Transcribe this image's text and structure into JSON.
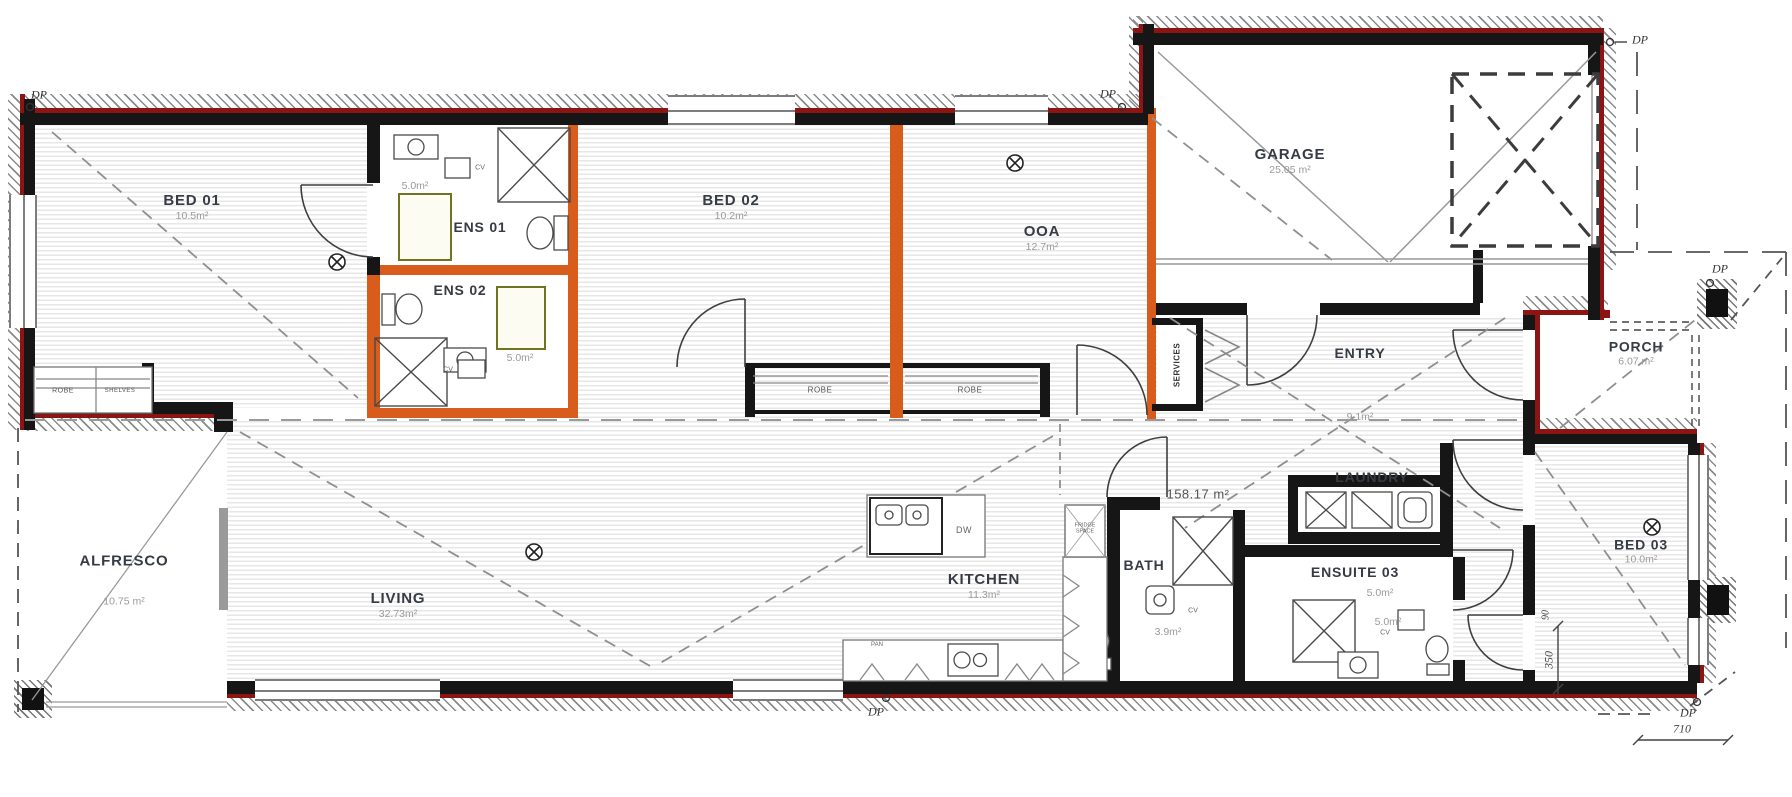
{
  "colors": {
    "wall_black": "#161616",
    "exterior_red": "#8c1412",
    "feature_orange": "#d85c1c",
    "hatch_gray": "#8a8a8a",
    "floor_stripe": "#e7e7e7",
    "mat_olive": "#6f7421"
  },
  "rooms": {
    "bed01": {
      "name": "BED 01",
      "area": "10.5m²"
    },
    "ens01": {
      "name": "ENS 01",
      "area": "5.0m²"
    },
    "ens02": {
      "name": "ENS 02",
      "area": "5.0m²"
    },
    "bed02": {
      "name": "BED 02",
      "area": "10.2m²"
    },
    "ooa": {
      "name": "OOA",
      "area": "12.7m²"
    },
    "garage": {
      "name": "GARAGE",
      "area": "25.05 m²"
    },
    "entry": {
      "name": "ENTRY",
      "area": "9.1m²"
    },
    "porch": {
      "name": "PORCH",
      "area": "6.07 m²"
    },
    "alfresco": {
      "name": "ALFRESCO",
      "area": "10.75 m²"
    },
    "living": {
      "name": "LIVING",
      "area": "32.73m²"
    },
    "kitchen": {
      "name": "KITCHEN",
      "area": "11.3m²"
    },
    "bath": {
      "name": "BATH",
      "area": "3.9m²"
    },
    "ensuite03": {
      "name": "ENSUITE 03",
      "area": "5.0m²",
      "area2": "5.0m²"
    },
    "laundry": {
      "name": "LAUNDRY"
    },
    "bed03": {
      "name": "BED 03",
      "area": "10.0m²"
    }
  },
  "labels": {
    "robe": "ROBE",
    "shelves": "SHELVES",
    "services": "SERVICES",
    "fridge_space": "FRIDGE SPACE",
    "dishwasher": "DW",
    "pantry": "PAN",
    "cv": "CV",
    "downpipe": "DP",
    "total_area": "158.17 m²"
  },
  "dimensions": {
    "d710": "710",
    "d350": "350",
    "d90": "90"
  }
}
